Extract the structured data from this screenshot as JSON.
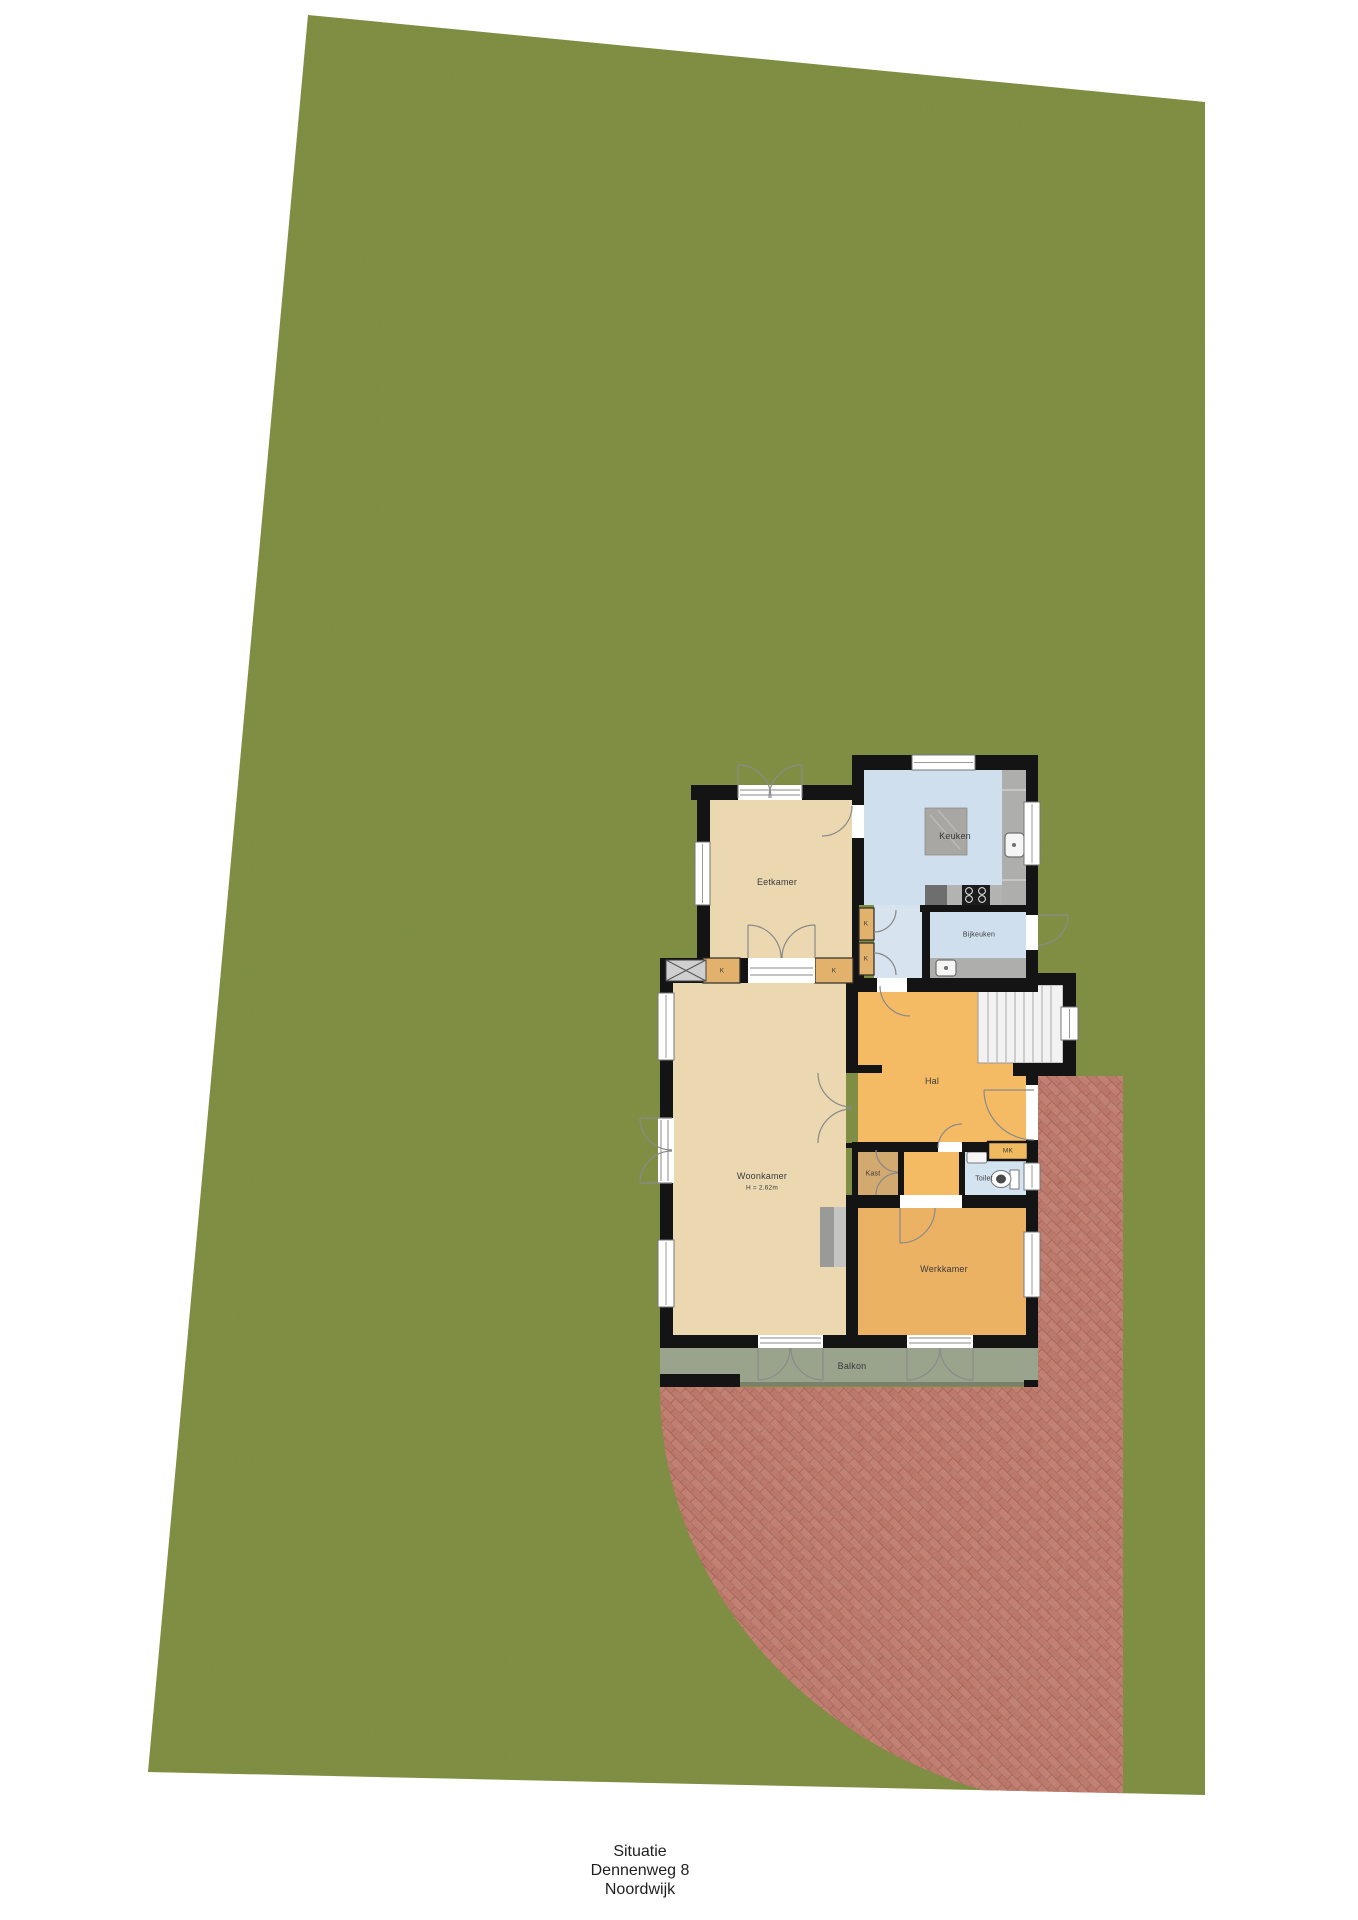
{
  "caption": {
    "line1": "Situatie",
    "line2": "Dennenweg 8",
    "line3": "Noordwijk"
  },
  "rooms": {
    "eetkamer": "Eetkamer",
    "keuken": "Keuken",
    "bijkeuken": "Bijkeuken",
    "hal": "Hal",
    "woonkamer": "Woonkamer",
    "woonkamer_height": "H = 2.62m",
    "kast": "Kast",
    "toilet": "Toilet",
    "mk": "MK",
    "werkkamer": "Werkkamer",
    "balkon": "Balkon",
    "kast_abbrev": "K"
  },
  "colors": {
    "grass": "#7d8e41",
    "paving_brick": "#c0796c",
    "wall_black": "#141414",
    "floor_tan": "#ebd8b0",
    "floor_orange_hal": "#f4bb64",
    "floor_orange_werkkamer": "#ecb264",
    "floor_blue": "#cfdfee",
    "balcony_gray_green": "#9aa48c",
    "counter_marble_gray": "#aeaeac"
  }
}
